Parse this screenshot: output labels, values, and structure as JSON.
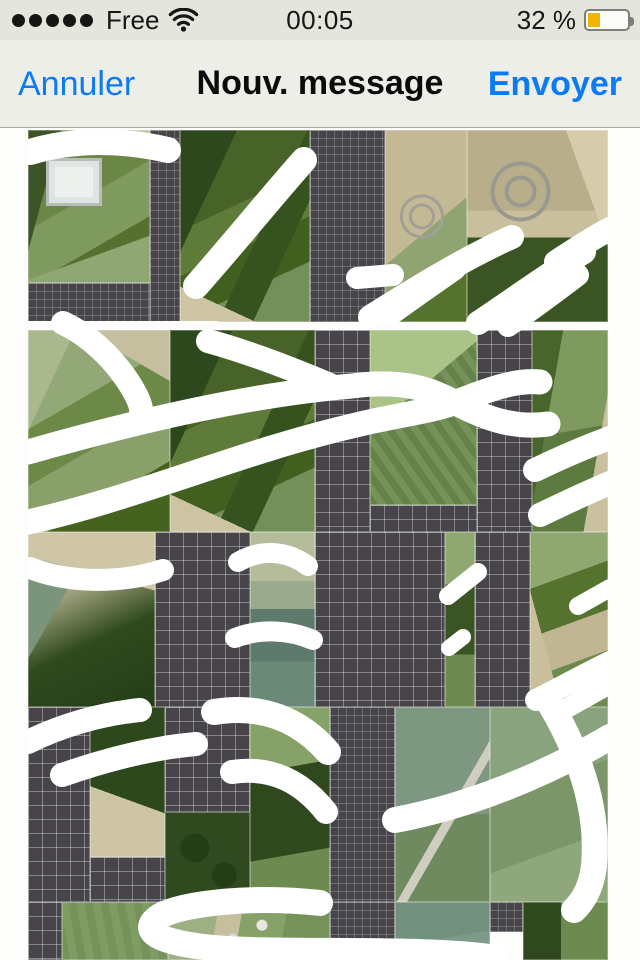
{
  "status_bar": {
    "carrier": "Free",
    "time": "00:05",
    "battery_percent": "32 %",
    "signal_dots": 5,
    "battery_level": 0.32,
    "battery_color": "#f1b500"
  },
  "nav_bar": {
    "cancel": "Annuler",
    "title": "Nouv. message",
    "send": "Envoyer",
    "accent_color": "#0b7bf5"
  },
  "attachment": {
    "description": "aerial map montage with white marker strokes and unloaded tile placeholders",
    "origin": {
      "x": 28,
      "y": 130
    },
    "size": {
      "w": 580,
      "h": 830
    },
    "stroke_color": "#ffffff",
    "placeholder_bg": "#47454a",
    "tiles": [
      {
        "x": 28,
        "y": 130,
        "w": 122,
        "h": 153,
        "k": "a1"
      },
      {
        "x": 28,
        "y": 283,
        "w": 122,
        "h": 39,
        "k": "ph",
        "g": "fine"
      },
      {
        "x": 150,
        "y": 130,
        "w": 30,
        "h": 192,
        "k": "ph",
        "g": "fine"
      },
      {
        "x": 180,
        "y": 130,
        "w": 130,
        "h": 192,
        "k": "a2"
      },
      {
        "x": 310,
        "y": 130,
        "w": 75,
        "h": 192,
        "k": "ph",
        "g": "fine"
      },
      {
        "x": 385,
        "y": 130,
        "w": 82,
        "h": 192,
        "k": "a3"
      },
      {
        "x": 467,
        "y": 130,
        "w": 141,
        "h": 192,
        "k": "a4"
      },
      {
        "x": 28,
        "y": 321,
        "w": 190,
        "h": 9,
        "k": "gap"
      },
      {
        "x": 28,
        "y": 330,
        "w": 142,
        "h": 202,
        "k": "a5"
      },
      {
        "x": 170,
        "y": 330,
        "w": 145,
        "h": 202,
        "k": "a2"
      },
      {
        "x": 315,
        "y": 330,
        "w": 55,
        "h": 202,
        "k": "ph"
      },
      {
        "x": 370,
        "y": 330,
        "w": 107,
        "h": 175,
        "k": "a6"
      },
      {
        "x": 370,
        "y": 505,
        "w": 107,
        "h": 27,
        "k": "ph"
      },
      {
        "x": 477,
        "y": 330,
        "w": 55,
        "h": 202,
        "k": "ph"
      },
      {
        "x": 532,
        "y": 330,
        "w": 76,
        "h": 202,
        "k": "a7"
      },
      {
        "x": 28,
        "y": 532,
        "w": 127,
        "h": 175,
        "k": "a8"
      },
      {
        "x": 155,
        "y": 532,
        "w": 95,
        "h": 175,
        "k": "ph"
      },
      {
        "x": 250,
        "y": 532,
        "w": 65,
        "h": 175,
        "k": "a9"
      },
      {
        "x": 315,
        "y": 532,
        "w": 130,
        "h": 175,
        "k": "ph"
      },
      {
        "x": 445,
        "y": 532,
        "w": 30,
        "h": 175,
        "k": "a10"
      },
      {
        "x": 475,
        "y": 532,
        "w": 55,
        "h": 175,
        "k": "ph"
      },
      {
        "x": 530,
        "y": 532,
        "w": 78,
        "h": 175,
        "k": "a11"
      },
      {
        "x": 28,
        "y": 707,
        "w": 62,
        "h": 195,
        "k": "ph"
      },
      {
        "x": 90,
        "y": 707,
        "w": 75,
        "h": 150,
        "k": "a12"
      },
      {
        "x": 90,
        "y": 857,
        "w": 75,
        "h": 45,
        "k": "ph"
      },
      {
        "x": 165,
        "y": 707,
        "w": 85,
        "h": 105,
        "k": "ph"
      },
      {
        "x": 165,
        "y": 812,
        "w": 85,
        "h": 90,
        "k": "a13"
      },
      {
        "x": 250,
        "y": 707,
        "w": 80,
        "h": 195,
        "k": "a14"
      },
      {
        "x": 330,
        "y": 707,
        "w": 65,
        "h": 195,
        "k": "ph",
        "g": "fine"
      },
      {
        "x": 395,
        "y": 707,
        "w": 95,
        "h": 195,
        "k": "a15"
      },
      {
        "x": 490,
        "y": 707,
        "w": 118,
        "h": 195,
        "k": "a16"
      },
      {
        "x": 28,
        "y": 902,
        "w": 34,
        "h": 58,
        "k": "ph"
      },
      {
        "x": 62,
        "y": 902,
        "w": 106,
        "h": 58,
        "k": "a17"
      },
      {
        "x": 168,
        "y": 902,
        "w": 162,
        "h": 58,
        "k": "a18"
      },
      {
        "x": 330,
        "y": 902,
        "w": 65,
        "h": 58,
        "k": "ph",
        "g": "fine"
      },
      {
        "x": 395,
        "y": 902,
        "w": 95,
        "h": 58,
        "k": "a19"
      },
      {
        "x": 490,
        "y": 902,
        "w": 33,
        "h": 30,
        "k": "ph",
        "g": "fine"
      },
      {
        "x": 523,
        "y": 902,
        "w": 85,
        "h": 58,
        "k": "a20"
      }
    ],
    "strokes": [
      {
        "d": "M30 152 C 70 140, 115 138, 168 150",
        "w": 26
      },
      {
        "d": "M304 160 C 272 196, 235 242, 196 286",
        "w": 26
      },
      {
        "d": "M357 278 L 393 275",
        "w": 22
      },
      {
        "d": "M370 317 C 418 287, 465 258, 512 237",
        "w": 24
      },
      {
        "d": "M390 315 C 412 299, 435 283, 455 269",
        "w": 22
      },
      {
        "d": "M478 323 C 518 296, 553 271, 584 252",
        "w": 24
      },
      {
        "d": "M508 326 C 533 309, 557 291, 578 275",
        "w": 22
      },
      {
        "d": "M556 262 C 585 243, 598 235, 610 229",
        "w": 24
      },
      {
        "d": "M63 323 C 95 338, 122 368, 136 395 C 139 401, 141 406, 141 410",
        "w": 24
      },
      {
        "d": "M208 341 C 248 352, 290 368, 330 385",
        "w": 24
      },
      {
        "d": "M28 452 C 140 420, 255 394, 352 386 C 405 379, 432 390, 458 404 C 492 422, 520 428, 548 424",
        "w": 25
      },
      {
        "d": "M28 522 C 130 500, 240 452, 352 426 C 400 414, 432 412, 462 400 C 495 387, 518 380, 540 382",
        "w": 25
      },
      {
        "d": "M535 470 C 560 458, 585 447, 610 438",
        "w": 24
      },
      {
        "d": "M540 515 C 565 503, 588 492, 610 483",
        "w": 24
      },
      {
        "d": "M30 568 C 68 583, 120 584, 163 570",
        "w": 22
      },
      {
        "d": "M238 562 C 262 548, 288 551, 308 566",
        "w": 20
      },
      {
        "d": "M235 638 C 260 628, 290 630, 313 640",
        "w": 20
      },
      {
        "d": "M448 596 L 478 572",
        "w": 18
      },
      {
        "d": "M449 648 L 463 637",
        "w": 16
      },
      {
        "d": "M578 606 L 610 588",
        "w": 18
      },
      {
        "d": "M536 700 C 560 688, 585 674, 610 662",
        "w": 22
      },
      {
        "d": "M556 714 C 578 702, 595 692, 610 684",
        "w": 20
      },
      {
        "d": "M28 742 C 60 726, 100 714, 140 710",
        "w": 24
      },
      {
        "d": "M62 775 C 105 760, 150 748, 196 744",
        "w": 24
      },
      {
        "d": "M214 712 C 262 704, 300 720, 328 752",
        "w": 26
      },
      {
        "d": "M232 772 C 272 766, 302 782, 326 812",
        "w": 24
      },
      {
        "d": "M395 820 C 470 806, 545 775, 610 737",
        "w": 26
      },
      {
        "d": "M549 702 C 580 754, 599 810, 594 866 C 591 889, 583 901, 574 910",
        "w": 26
      },
      {
        "d": "M320 903 C 258 896, 186 902, 160 916 C 140 929, 153 941, 204 947 C 272 955, 420 946, 497 958",
        "w": 26
      }
    ]
  }
}
